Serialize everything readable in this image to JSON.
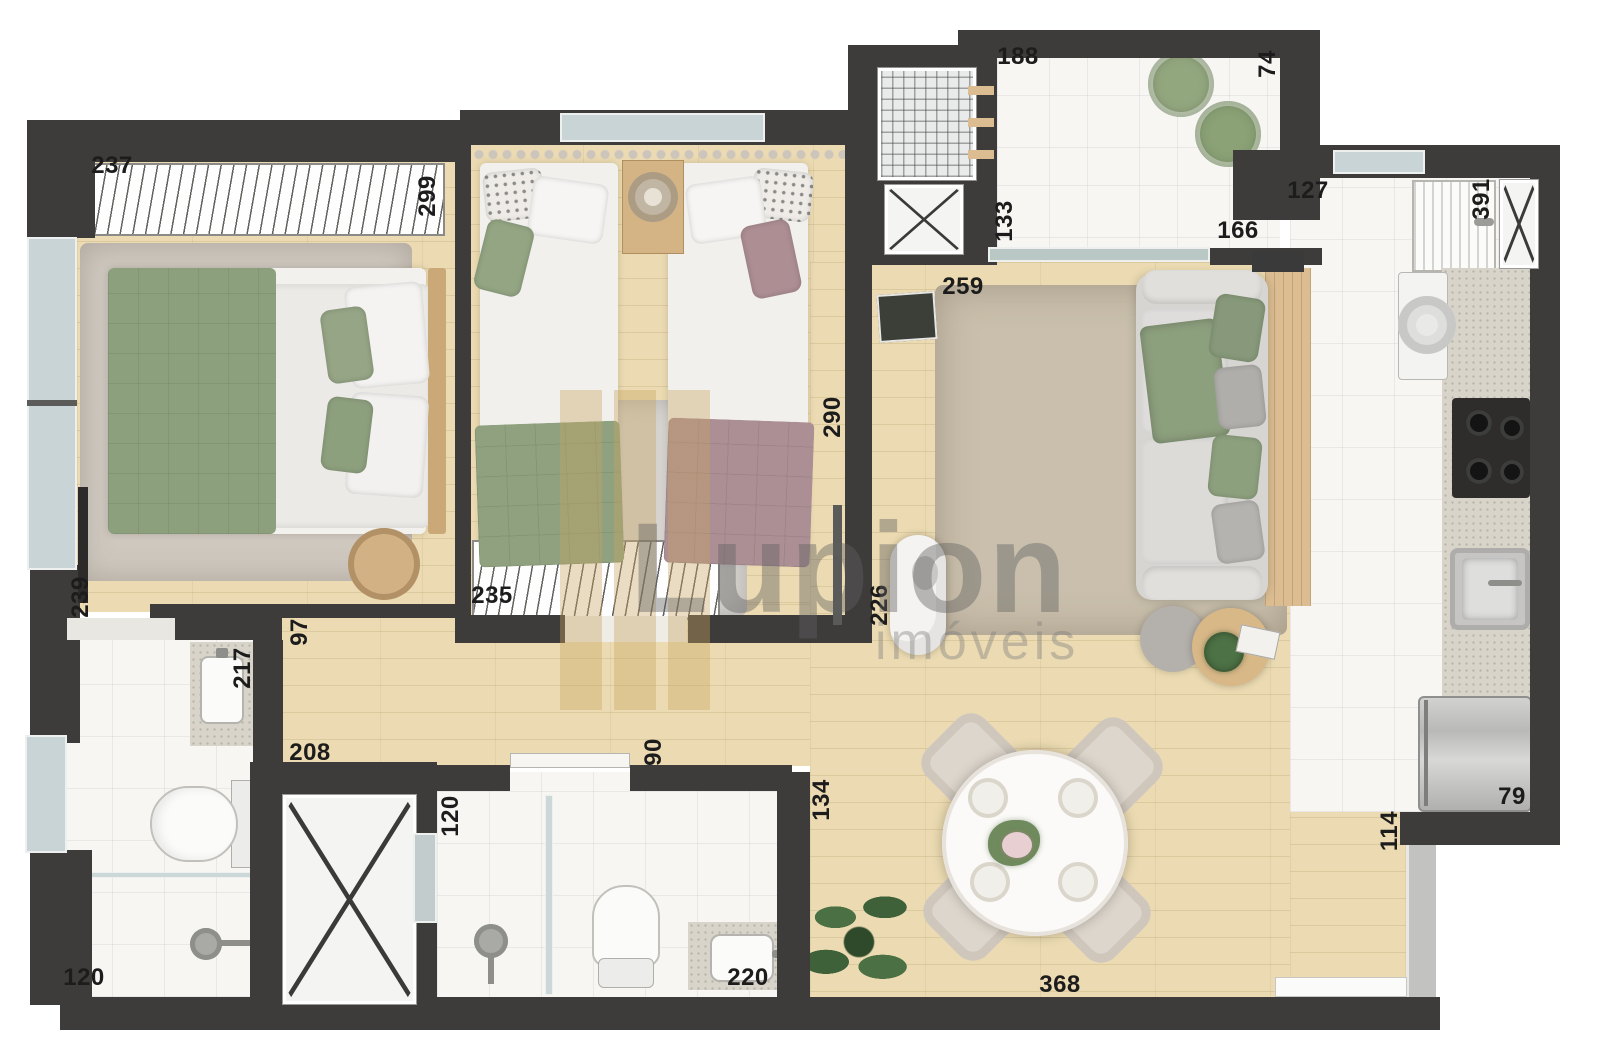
{
  "watermark": {
    "brand": "Lupion",
    "sub": "imóveis"
  },
  "dims": {
    "master_closet_width": "237",
    "master_depth": "299",
    "service_width": "188",
    "balcony_depth": "74",
    "service_height": "133",
    "balcony_door_width": "166",
    "kitchen_passage": "127",
    "kitchen_depth": "391",
    "living_width": "259",
    "bedroom2_depth": "290",
    "master_door_wall": "239",
    "hall_width": "97",
    "bedroom2_closet_width": "235",
    "sideboard_height": "226",
    "bath1_vanity": "217",
    "hall_length": "208",
    "bath2_door": "90",
    "bath2_shower_door": "120",
    "living_left_wall": "134",
    "bath1_width": "120",
    "bath2_vanity": "220",
    "living_length": "368",
    "fridge_width": "79",
    "entry_wall": "114"
  }
}
